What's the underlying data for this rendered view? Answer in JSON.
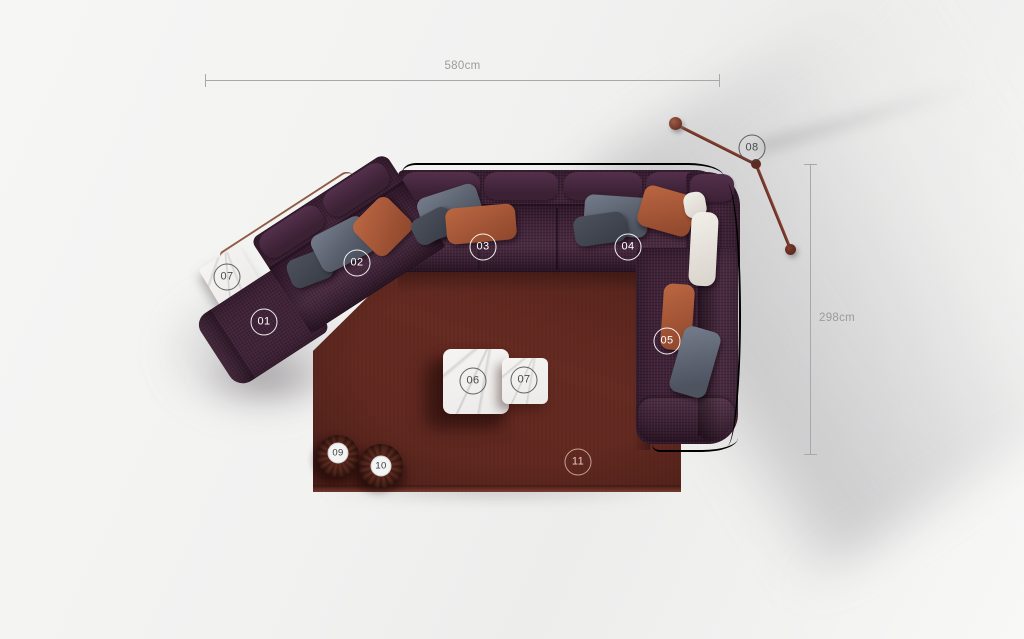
{
  "dimensions": {
    "horizontal": {
      "label": "580cm"
    },
    "vertical": {
      "label": "298cm"
    }
  },
  "markers": [
    {
      "id": "01"
    },
    {
      "id": "02"
    },
    {
      "id": "03"
    },
    {
      "id": "04"
    },
    {
      "id": "05"
    },
    {
      "id": "06"
    },
    {
      "id": "07"
    },
    {
      "id": "07"
    },
    {
      "id": "08"
    },
    {
      "id": "09"
    },
    {
      "id": "10"
    },
    {
      "id": "11"
    }
  ],
  "colors": {
    "sofa_fabric": "#3f2338",
    "sofa_fabric_light": "#4e2c46",
    "rug": "#662b22",
    "pillow_rust": "#ac5a3e",
    "pillow_gray": "#5c6370",
    "pillow_gray_dark": "#454a55",
    "pillow_white": "#ece9e3",
    "marble": "#f1f0ee",
    "frame_bronze": "#7d4530",
    "lamp": "#7b392c",
    "dimension": "#9b9b9b"
  }
}
